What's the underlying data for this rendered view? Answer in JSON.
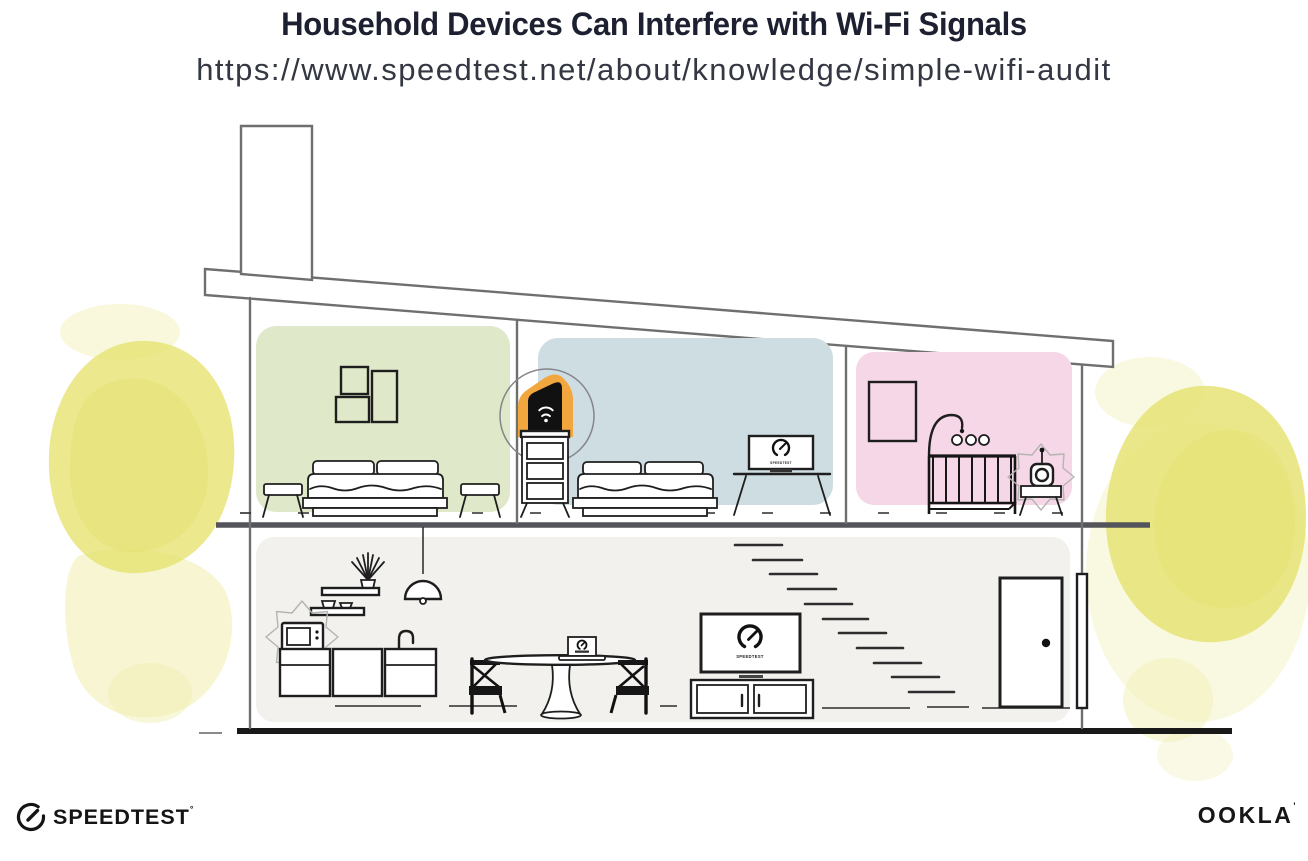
{
  "header": {
    "title": "Household Devices Can Interfere with Wi-Fi Signals",
    "url": "https://www.speedtest.net/about/knowledge/simple-wifi-audit"
  },
  "illustration": {
    "screen_label": "SPEEDTEST",
    "icons": {
      "router": "wifi-router-icon",
      "gauge": "speedtest-gauge-icon",
      "interference": "interference-burst-icon"
    }
  },
  "footer": {
    "speedtest_logo": "SPEEDTEST",
    "speedtest_mark": "°",
    "ookla_logo": "OOKLA",
    "ookla_mark": "'"
  },
  "colors": {
    "title-color": "#1c2030",
    "subtitle-color": "#343843",
    "accent-orange": "#f2a63e",
    "wall-green": "#dfe8c9",
    "wall-blue": "#cddde1",
    "wall-pink": "#f6d7e8",
    "floor-gray": "#f2f1ee",
    "watercolor": "#e5e16e",
    "watercolor-light": "#f1efb4",
    "structure-line": "#6f6f6d",
    "ink": "#1e1e1e"
  }
}
